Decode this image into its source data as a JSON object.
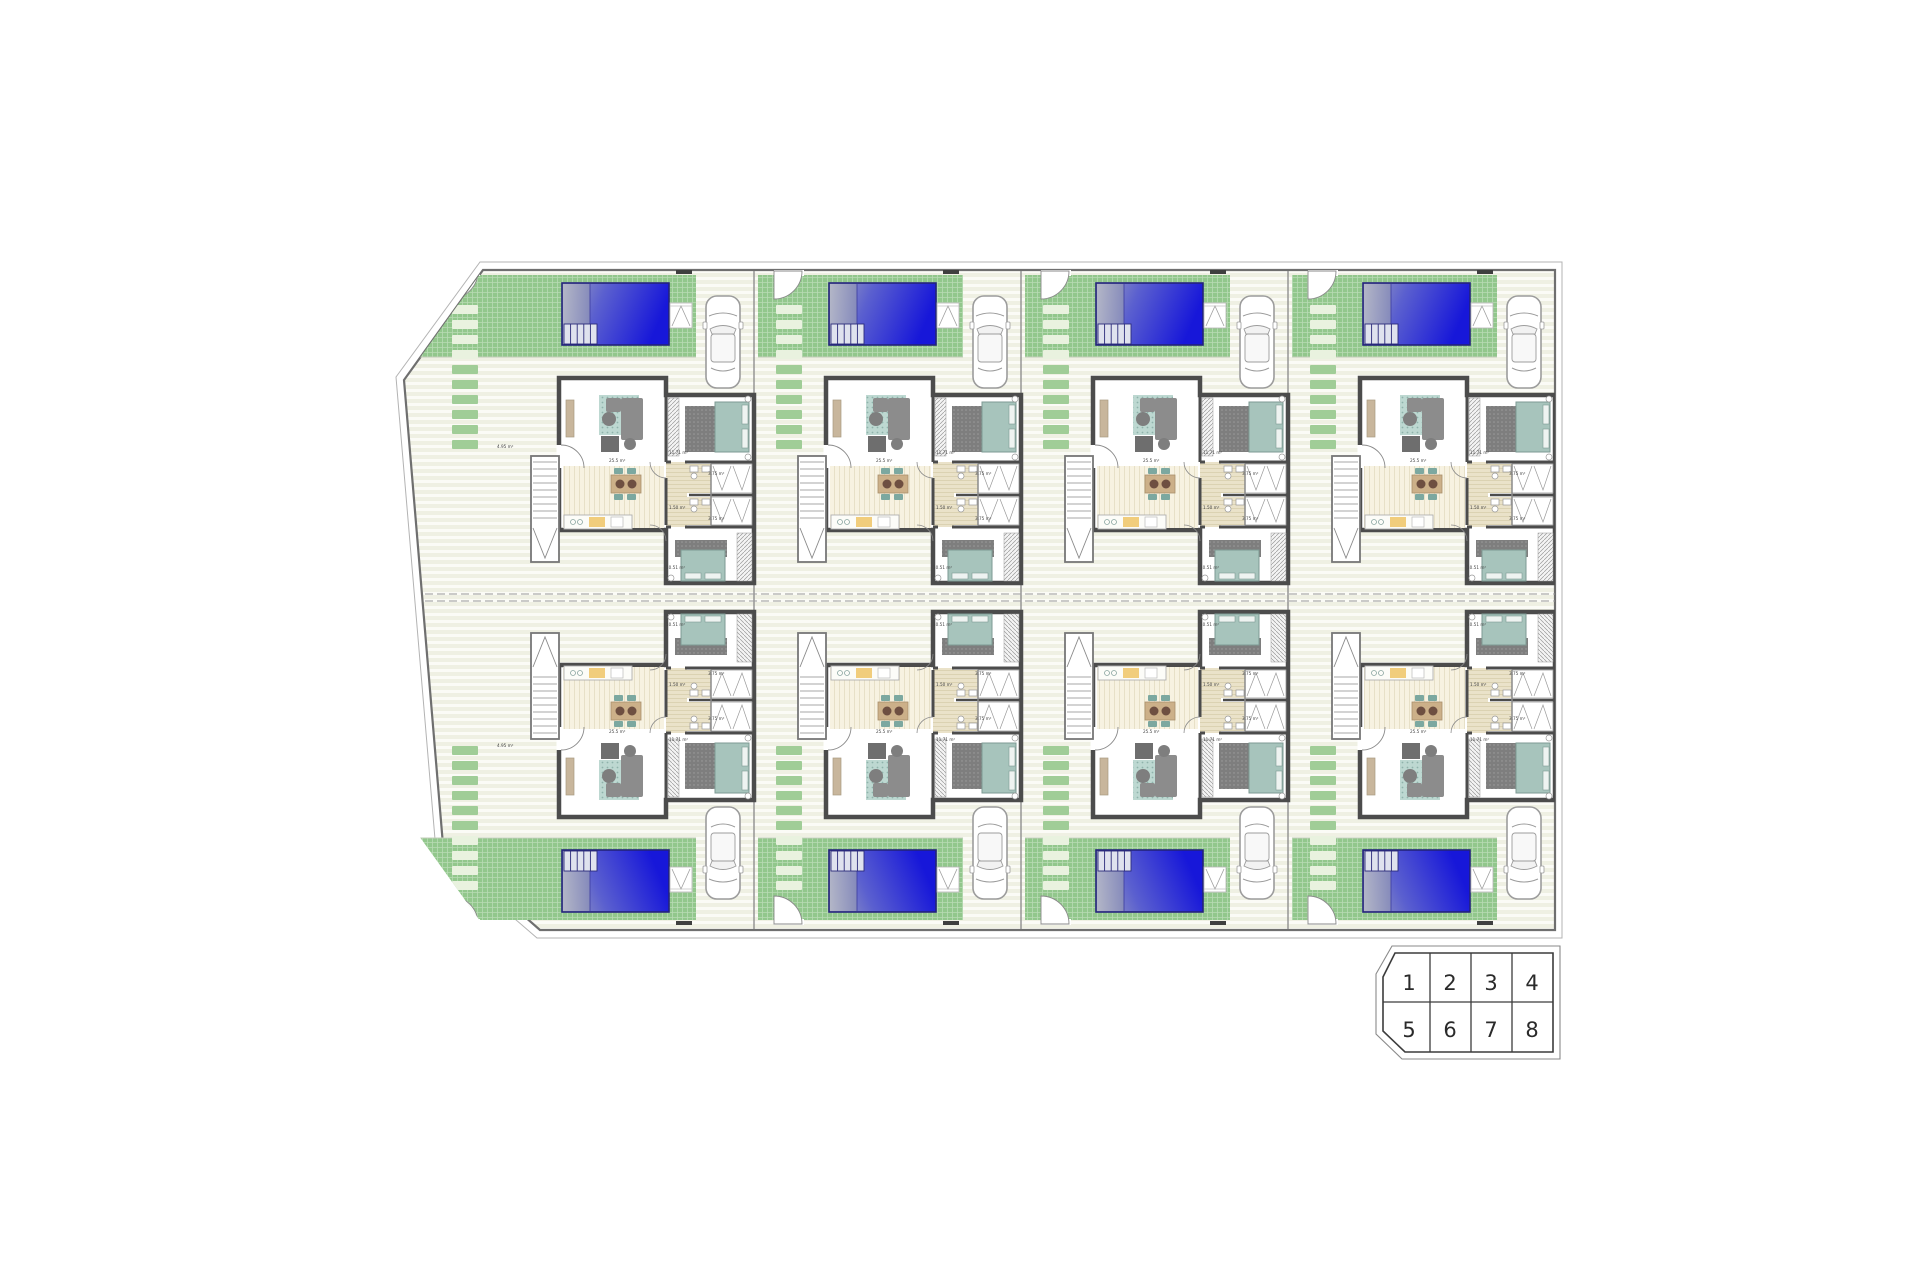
{
  "key_plan": {
    "cells": [
      "1",
      "2",
      "3",
      "4",
      "5",
      "6",
      "7",
      "8"
    ]
  },
  "villa": {
    "room_labels": [
      {
        "id": "living-room",
        "text": "25.5 m²"
      },
      {
        "id": "bedroom-1",
        "text": "11.71 m²"
      },
      {
        "id": "bathroom-1",
        "text": "3.75 m²"
      },
      {
        "id": "bathroom-2",
        "text": "3.75 m²"
      },
      {
        "id": "hall",
        "text": "1.50 m²"
      },
      {
        "id": "bedroom-2",
        "text": "10.51 m²"
      },
      {
        "id": "porch",
        "text": "4.95 m²"
      }
    ]
  },
  "colors": {
    "pool_deep": "#1717d9",
    "pool_mid": "#5b60cf",
    "pool_gray": "#a0a4bf",
    "pool_border": "#23237a",
    "garden_green": "#92c78c",
    "stone_green": "#a0cd97",
    "stone_light": "#e9f2df",
    "terrace_a": "#eff0e3",
    "terrace_b": "#fbfbf6",
    "wood_a": "#f7f2e1",
    "wood_b": "#e7e0c7",
    "bath_a": "#eae2c9",
    "bath_b": "#dbd2b2",
    "wall_gray": "#4c4c4c",
    "fence_gray": "#8f8f8f",
    "boundary_gray": "#6f6f6f",
    "rug_teal": "#bdd8d1",
    "rug_teal_dot": "#8fb3ab",
    "bed_teal": "#a7c4bc",
    "bed_frame": "#7d9a93",
    "dark_rug": "#7e7e7e",
    "dark_rug_dot": "#9b9b9b",
    "sofa_gray": "#8c8c8c",
    "table_tan": "#ccb089",
    "plate_brown": "#6e4f41",
    "chair_teal": "#7ca8a0",
    "console_tan": "#c8b69c",
    "counter_yellow": "#f1cd7c",
    "car_stroke": "#9c9c9c",
    "label_gray": "#444444",
    "key_stroke": "#3c3c3c",
    "key_text": "#2a2a2a"
  }
}
